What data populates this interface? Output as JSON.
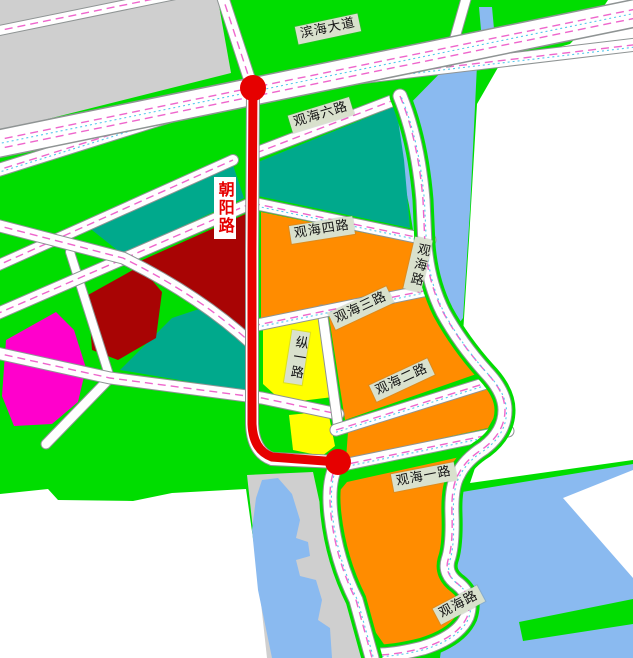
{
  "map": {
    "title": "urban-planning-road-map",
    "road_labels": [
      {
        "id": "binhai-avenue",
        "text": "滨海大道",
        "orientation": "horizontal"
      },
      {
        "id": "guanhai-6-road",
        "text": "观海六路",
        "orientation": "horizontal"
      },
      {
        "id": "chaoyang-road",
        "text": "朝阳路",
        "orientation": "vertical",
        "highlight": "red-route"
      },
      {
        "id": "guanhai-4-road",
        "text": "观海四路",
        "orientation": "horizontal"
      },
      {
        "id": "guanhai-road-east",
        "text": "观海路",
        "orientation": "vertical"
      },
      {
        "id": "guanhai-3-road",
        "text": "观海三路",
        "orientation": "horizontal"
      },
      {
        "id": "zong-1-road",
        "text": "纵一路",
        "orientation": "vertical"
      },
      {
        "id": "guanhai-2-road",
        "text": "观海二路",
        "orientation": "horizontal"
      },
      {
        "id": "guanhai-1-road",
        "text": "观海一路",
        "orientation": "horizontal"
      },
      {
        "id": "guanhai-road-south",
        "text": "观海路",
        "orientation": "horizontal"
      }
    ],
    "route": {
      "name": "朝阳路",
      "color": "#e60000",
      "endpoints": 2
    },
    "colors": {
      "open_space_green": "#00dd00",
      "parcel_teal": "#00a98c",
      "parcel_orange": "#ff8c00",
      "parcel_dark_red": "#a80404",
      "parcel_magenta": "#ff00cc",
      "parcel_yellow": "#ffff00",
      "water_blue": "#8abaf0",
      "built_gray": "#cfcfcf",
      "road_white": "#ffffff",
      "route_red": "#e60000",
      "label_bg": "#d9e1cd"
    }
  }
}
